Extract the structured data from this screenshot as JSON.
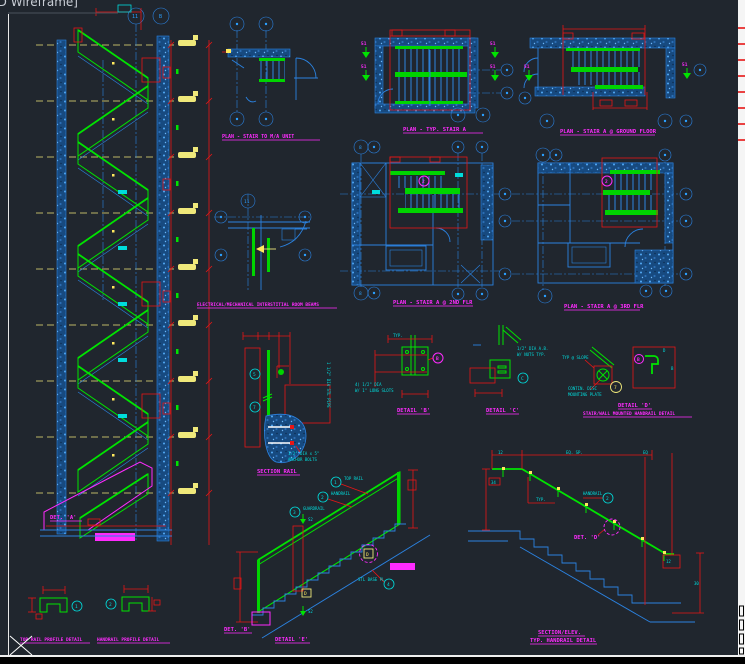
{
  "viewport": {
    "control_label": "2D Wireframe]"
  },
  "colors": {
    "background": "#20262e",
    "line_blue": "#2b82e0",
    "bubble_blue": "#2ba0ff",
    "green": "#00e400",
    "red": "#e81616",
    "magenta": "#ff2bff",
    "cyan": "#00dcdc",
    "yellow": "#efe87a",
    "white": "#ffffff"
  },
  "glyphs": {
    "n1": "1",
    "n2": "2",
    "n3": "3",
    "n4": "4",
    "n5": "5",
    "n7": "7",
    "n8": "8",
    "n11": "11",
    "n12": "12",
    "n51": "51",
    "lB": "B",
    "lC": "C",
    "lD": "D",
    "lE": "E",
    "s2": "S2",
    "n34": "34",
    "n30": "30"
  },
  "drawings": {
    "stair_section": {
      "detail_ref": "DET. 'A'"
    },
    "plan_mia_unit": {
      "title": "PLAN - STAIR TO M/A UNIT"
    },
    "elev_mech": {
      "title": "ELECTRICAL/MECHANICAL INTERSTITIAL ROOM BEAMS"
    },
    "plan_typ_stair_a": {
      "title": "PLAN - TYP. STAIR A"
    },
    "plan_ground": {
      "title": "PLAN - STAIR A @ GROUND FLOOR"
    },
    "plan_2nd": {
      "title": "PLAN - STAIR A @ 2ND FLR"
    },
    "plan_3rd": {
      "title": "PLAN - STAIR A @ 3RD FLR"
    },
    "section_rail": {
      "title": "SECTION RAIL",
      "note_pipe": "1 1/2\" DIA STL PIPE",
      "note_anchor1": "1/2\" DIA x 5\"",
      "note_anchor2": "ANCHOR BOLTS"
    },
    "detail_b": {
      "title": "DETAIL 'B'",
      "note_typ": "TYP.",
      "note1": "4) 1/2\" DIA",
      "note2": "W/ 1\" LONG SLOTS"
    },
    "detail_c": {
      "title": "DETAIL 'C'",
      "note1": "1/2\" DIA A.B.",
      "note2": "W/ NUTS TYP."
    },
    "detail_d": {
      "title": "DETAIL 'D'",
      "subtitle": "STAIR/WALL MOUNTED HANDRAIL DETAIL",
      "note_slope": "TYP @ SLOPE",
      "note_plate1": "CONTIN. DISC",
      "note_plate2": "MOUNTING PLATE"
    },
    "top_rail_profile": {
      "title": "TOP RAIL PROFILE DETAIL"
    },
    "handrail_profile": {
      "title": "HANDRAIL PROFILE DETAIL"
    },
    "detail_e": {
      "title": "DETAIL 'E'",
      "detail_ref": "DET. 'B'",
      "callout_top_rail": "TOP RAIL",
      "callout_handrail": "HANDRAIL",
      "callout_guardrail": "GUARDRAIL",
      "callout_base": "STL BASE PL"
    },
    "handrail_elev": {
      "title1": "SECTION/ELEV.",
      "title2": "TYP. HANDRAIL DETAIL",
      "detail_ref": "DET. 'D'",
      "callout_handrail": "HANDRAIL",
      "dim_a": "12",
      "dim_b": "EQ. SP.",
      "dim_c": "EQ",
      "dim_end": "12",
      "note_typ": "TYP."
    }
  }
}
